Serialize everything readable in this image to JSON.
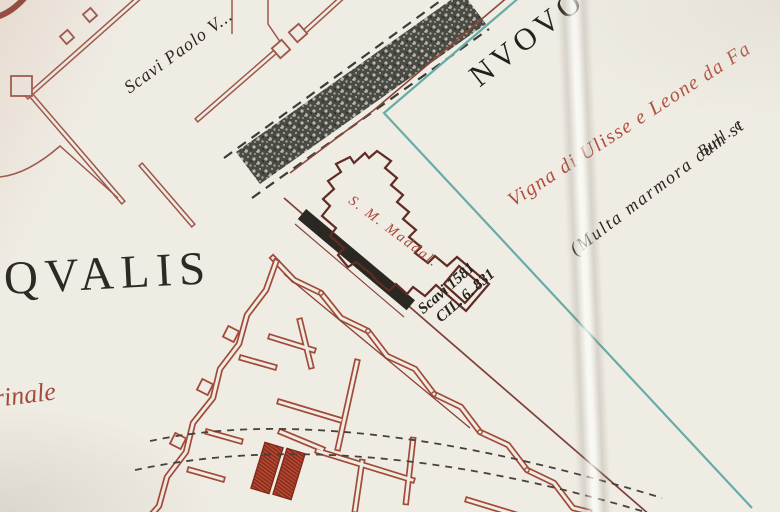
{
  "labels": {
    "hill_name": "QVALIS",
    "street_name": "rinale",
    "district_name": "NVOVO",
    "note_scavi_paolo": "Scavi Paolo V...",
    "note_vigna": "Vigna di Ulisse e Leone da Fa",
    "note_multa": "(Multa marmora cum st",
    "note_bull": "Bull. c",
    "church_label": "S. M. Maddal.",
    "note_scavi_1581": "Scavi 1581",
    "note_cil": "CIL. 6. 831"
  },
  "colors": {
    "paper": "#efece4",
    "wall_light_red": "#9d574a",
    "wall_brick": "#a24a38",
    "wall_dark": "#5f2b24",
    "fill_black": "#2b2823",
    "excavation_fill": "#b8472f",
    "survey_teal": "#68aca6",
    "ink": "#26221d",
    "label_red": "#b24c39",
    "band_dark": "#4a4b44"
  }
}
